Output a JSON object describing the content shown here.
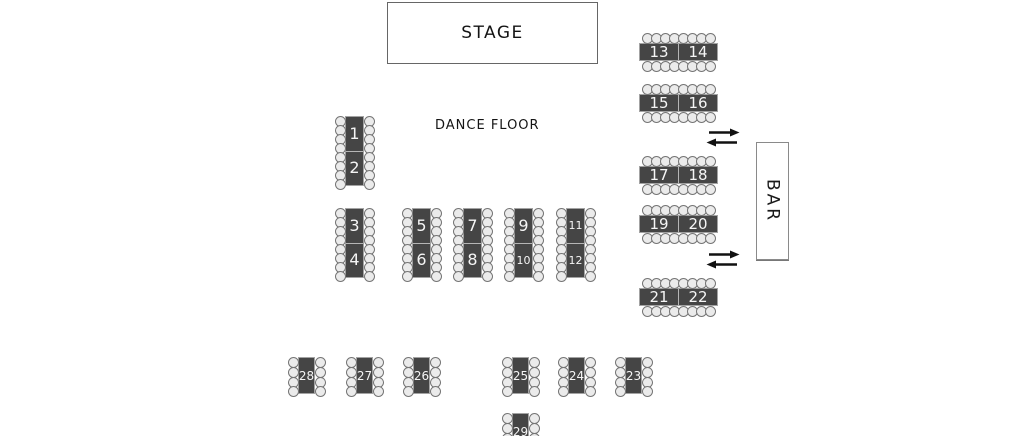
{
  "scene": {
    "width": 1024,
    "height": 436,
    "background": "#ffffff"
  },
  "colors": {
    "table_fill": "#454545",
    "table_border": "#a3a3a3",
    "table_number_text": "#f5f5f5",
    "cell_divider": "#b5b5b5",
    "chair_fill": "#ebebeb",
    "chair_stroke": "#757575",
    "label_text": "#141414",
    "arrow": "#111111"
  },
  "stage": {
    "label": "STAGE",
    "x": 387,
    "y": 2,
    "w": 209,
    "h": 60
  },
  "dance_floor": {
    "label": "DANCE FLOOR",
    "x": 435,
    "y": 118
  },
  "bar": {
    "label": "BAR",
    "x": 756,
    "y": 142,
    "w": 31,
    "h": 116
  },
  "arrows": [
    {
      "name": "passage-arrows-top",
      "x": 706,
      "y": 128
    },
    {
      "name": "passage-arrows-bottom",
      "x": 706,
      "y": 250
    }
  ],
  "tables": [
    {
      "type": "v-pair",
      "cells": [
        "1",
        "2"
      ],
      "chairs": 16,
      "x": 345,
      "y": 116
    },
    {
      "type": "v-pair",
      "cells": [
        "3",
        "4"
      ],
      "chairs": 16,
      "x": 345,
      "y": 208
    },
    {
      "type": "v-pair",
      "cells": [
        "5",
        "6"
      ],
      "chairs": 16,
      "x": 412,
      "y": 208
    },
    {
      "type": "v-pair",
      "cells": [
        "7",
        "8"
      ],
      "chairs": 16,
      "x": 463,
      "y": 208
    },
    {
      "type": "v-pair",
      "cells": [
        "9",
        "10"
      ],
      "chairs": 16,
      "x": 514,
      "y": 208
    },
    {
      "type": "v-pair",
      "cells": [
        "11",
        "12"
      ],
      "chairs": 16,
      "x": 566,
      "y": 208
    },
    {
      "type": "h-pair",
      "cells": [
        "13",
        "14"
      ],
      "chairs": 16,
      "x": 639,
      "y": 43
    },
    {
      "type": "h-pair",
      "cells": [
        "15",
        "16"
      ],
      "chairs": 16,
      "x": 639,
      "y": 94
    },
    {
      "type": "h-pair",
      "cells": [
        "17",
        "18"
      ],
      "chairs": 16,
      "x": 639,
      "y": 166
    },
    {
      "type": "h-pair",
      "cells": [
        "19",
        "20"
      ],
      "chairs": 16,
      "x": 639,
      "y": 215
    },
    {
      "type": "h-pair",
      "cells": [
        "21",
        "22"
      ],
      "chairs": 16,
      "x": 639,
      "y": 288
    },
    {
      "type": "v-single",
      "cells": [
        "28"
      ],
      "chairs": 8,
      "x": 298,
      "y": 357
    },
    {
      "type": "v-single",
      "cells": [
        "27"
      ],
      "chairs": 8,
      "x": 356,
      "y": 357
    },
    {
      "type": "v-single",
      "cells": [
        "26"
      ],
      "chairs": 8,
      "x": 413,
      "y": 357
    },
    {
      "type": "v-single",
      "cells": [
        "25"
      ],
      "chairs": 8,
      "x": 512,
      "y": 357
    },
    {
      "type": "v-single",
      "cells": [
        "24"
      ],
      "chairs": 8,
      "x": 568,
      "y": 357
    },
    {
      "type": "v-single",
      "cells": [
        "23"
      ],
      "chairs": 8,
      "x": 625,
      "y": 357
    },
    {
      "type": "v-single",
      "cells": [
        "29"
      ],
      "chairs": 8,
      "x": 512,
      "y": 413
    }
  ]
}
